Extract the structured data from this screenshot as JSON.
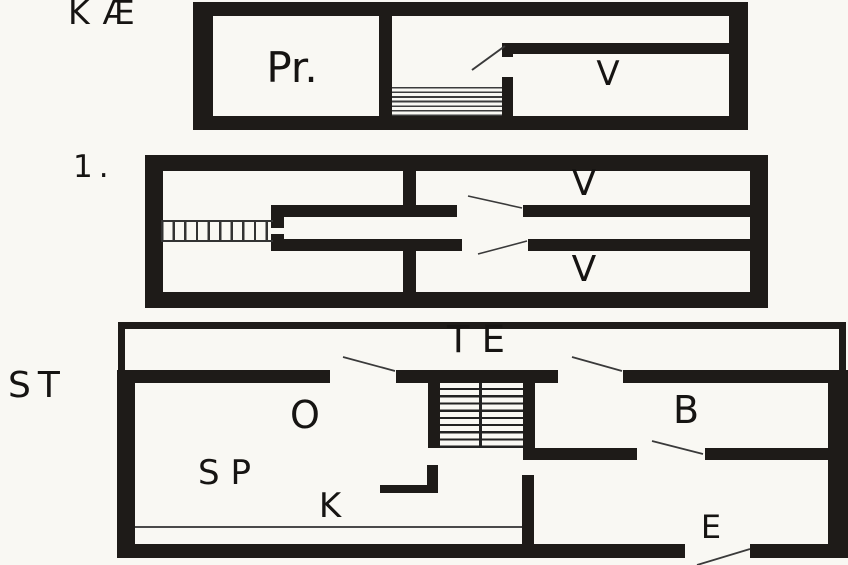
{
  "plan": {
    "title": "three-storey floor plan",
    "colors": {
      "wall": "#1e1b18",
      "background": "#f9f8f3",
      "swing": "#3a3a3a",
      "counter": "#4a4a4a"
    },
    "floors": [
      {
        "id": "basement",
        "label": "KÆ",
        "rooms": [
          {
            "name": "Pr."
          },
          {
            "name": "V"
          }
        ]
      },
      {
        "id": "first-floor",
        "label": "1.",
        "rooms": [
          {
            "name": "V"
          },
          {
            "name": "V"
          }
        ]
      },
      {
        "id": "ground-floor",
        "label": "ST",
        "rooms": [
          {
            "name": "TE"
          },
          {
            "name": "O"
          },
          {
            "name": "B"
          },
          {
            "name": "SP"
          },
          {
            "name": "K"
          },
          {
            "name": "E"
          }
        ]
      }
    ]
  }
}
